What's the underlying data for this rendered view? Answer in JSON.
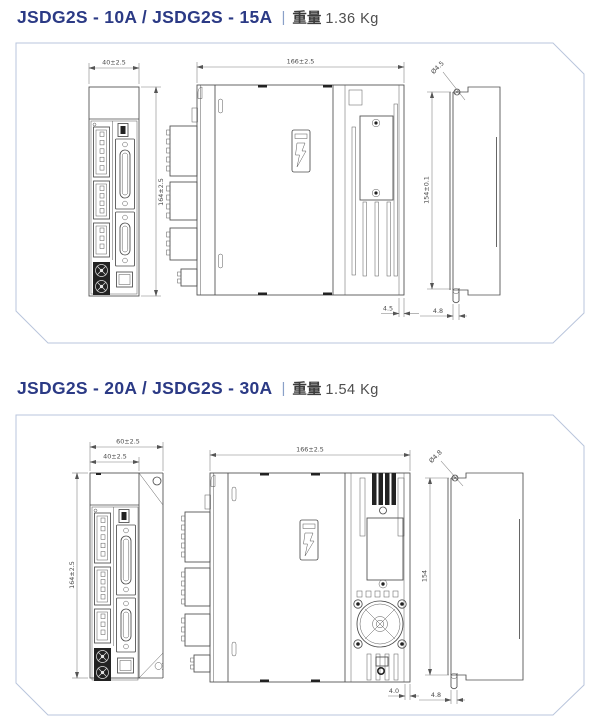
{
  "page": {
    "background": "#ffffff",
    "title_color": "#2b3a85",
    "panel_border_color": "#b9c5dc"
  },
  "sections": [
    {
      "title": {
        "model": "JSDG2S - 10A / JSDG2S - 15A",
        "separator": "|",
        "weight_label": "重量",
        "weight_value": "1.36 Kg"
      },
      "dimensions": {
        "front_width": "40±2.5",
        "front_height": "164±2.5",
        "side_width": "166±2.5",
        "side_plate_thickness": "4.5",
        "rear_hole_diameter": "Ø4.5",
        "rear_mount_pitch": "154±0.1",
        "rear_slot_width": "4.8"
      }
    },
    {
      "title": {
        "model": "JSDG2S - 20A / JSDG2S - 30A",
        "separator": "|",
        "weight_label": "重量",
        "weight_value": "1.54 Kg"
      },
      "dimensions": {
        "front_outer_width": "60±2.5",
        "front_width": "40±2.5",
        "front_height": "164±2.5",
        "side_width": "166±2.5",
        "side_plate_thickness": "4.0",
        "rear_hole_diameter": "Ø4.8",
        "rear_mount_pitch": "154",
        "rear_slot_width": "4.8"
      }
    }
  ]
}
